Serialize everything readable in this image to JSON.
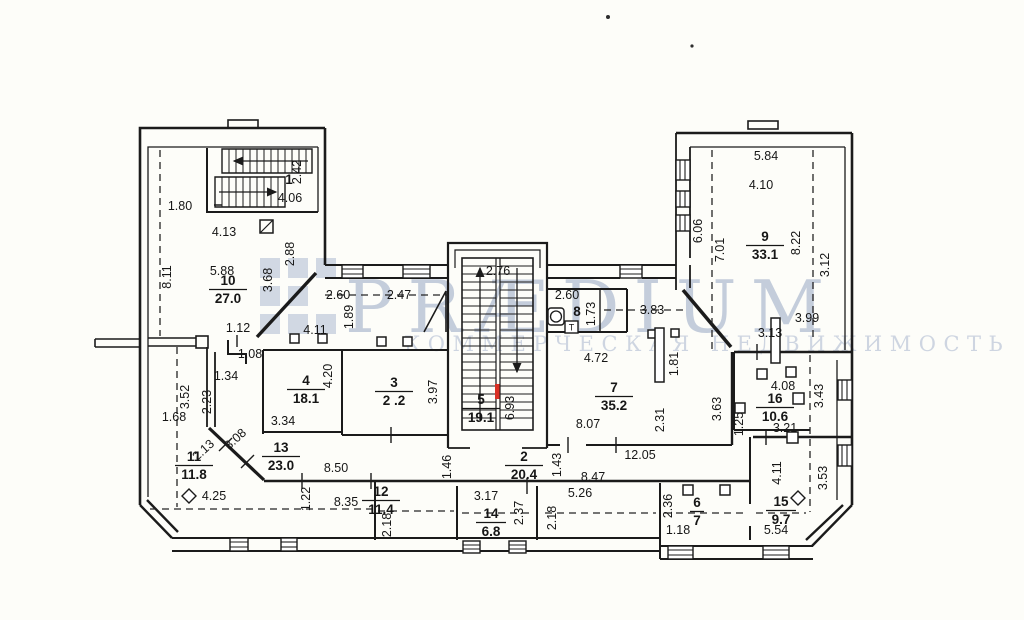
{
  "watermark": {
    "brand": "PRÆDIUM",
    "subtitle": "КОММЕРЧЕСКАЯ НЕДВИЖИМОСТЬ",
    "brand_color": "#b7c2d4",
    "subtitle_color": "#c6cfdd"
  },
  "colors": {
    "wall": "#1b1b1b",
    "red_mark": "#d93025",
    "paper": "#fdfdf9"
  },
  "symbols": {
    "towel_dryer_label": "Т"
  },
  "rooms": [
    {
      "number": "1",
      "area": "",
      "x": 289,
      "y": 184
    },
    {
      "number": "10",
      "area": "27.0",
      "x": 228,
      "y": 285
    },
    {
      "number": "4",
      "area": "18.1",
      "x": 306,
      "y": 385
    },
    {
      "number": "3",
      "area": "2 .2",
      "x": 394,
      "y": 387
    },
    {
      "number": "5",
      "area": "19.1",
      "x": 481,
      "y": 404
    },
    {
      "number": "2",
      "area": "20.4",
      "x": 524,
      "y": 461
    },
    {
      "number": "7",
      "area": "35.2",
      "x": 614,
      "y": 392
    },
    {
      "number": "8",
      "area": "",
      "x": 577,
      "y": 316
    },
    {
      "number": "9",
      "area": "33.1",
      "x": 765,
      "y": 241
    },
    {
      "number": "11",
      "area": "11.8",
      "x": 194,
      "y": 461
    },
    {
      "number": "12",
      "area": "11.4",
      "x": 381,
      "y": 496
    },
    {
      "number": "13",
      "area": "23.0",
      "x": 281,
      "y": 452
    },
    {
      "number": "14",
      "area": "6.8",
      "x": 491,
      "y": 518
    },
    {
      "number": "15",
      "area": "9.7",
      "x": 781,
      "y": 506
    },
    {
      "number": "16",
      "area": "10.6",
      "x": 775,
      "y": 403
    },
    {
      "number": "6",
      "area": "7",
      "x": 697,
      "y": 507
    }
  ],
  "dimensions": [
    {
      "t": "1.80",
      "x": 180,
      "y": 210,
      "r": 0
    },
    {
      "t": "8.11",
      "x": 171,
      "y": 277,
      "r": -90
    },
    {
      "t": "4.13",
      "x": 224,
      "y": 236,
      "r": 0
    },
    {
      "t": "5.88",
      "x": 222,
      "y": 275,
      "r": 0
    },
    {
      "t": "2.42",
      "x": 301,
      "y": 172,
      "r": -90
    },
    {
      "t": "4.06",
      "x": 290,
      "y": 202,
      "r": 0
    },
    {
      "t": "2.88",
      "x": 294,
      "y": 254,
      "r": -90
    },
    {
      "t": "3.68",
      "x": 272,
      "y": 280,
      "r": -90
    },
    {
      "t": "2.60",
      "x": 338,
      "y": 299,
      "r": 0
    },
    {
      "t": "2.47",
      "x": 399,
      "y": 299,
      "r": 0
    },
    {
      "t": "1.89",
      "x": 353,
      "y": 317,
      "r": -90
    },
    {
      "t": "4.11",
      "x": 315,
      "y": 334,
      "r": 0
    },
    {
      "t": "1.12",
      "x": 238,
      "y": 332,
      "r": 0
    },
    {
      "t": "1.08",
      "x": 250,
      "y": 358,
      "r": 0
    },
    {
      "t": "1.34",
      "x": 226,
      "y": 380,
      "r": 0
    },
    {
      "t": "3.52",
      "x": 189,
      "y": 397,
      "r": -90
    },
    {
      "t": "2.23",
      "x": 211,
      "y": 402,
      "r": -90
    },
    {
      "t": "1.68",
      "x": 174,
      "y": 421,
      "r": 0
    },
    {
      "t": "2.13",
      "x": 206,
      "y": 453,
      "r": -42
    },
    {
      "t": "3.08",
      "x": 238,
      "y": 442,
      "r": -42
    },
    {
      "t": "4.25",
      "x": 214,
      "y": 500,
      "r": 0
    },
    {
      "t": "3.34",
      "x": 283,
      "y": 425,
      "r": 0
    },
    {
      "t": "4.20",
      "x": 332,
      "y": 376,
      "r": -90
    },
    {
      "t": "3.97",
      "x": 437,
      "y": 392,
      "r": -90
    },
    {
      "t": "2.76",
      "x": 498,
      "y": 275,
      "r": 0
    },
    {
      "t": "6.93",
      "x": 514,
      "y": 408,
      "r": -90
    },
    {
      "t": "2.60",
      "x": 567,
      "y": 299,
      "r": 0
    },
    {
      "t": "1.73",
      "x": 595,
      "y": 314,
      "r": -90
    },
    {
      "t": "3.83",
      "x": 652,
      "y": 314,
      "r": 0
    },
    {
      "t": "4.72",
      "x": 596,
      "y": 362,
      "r": 0
    },
    {
      "t": "1.81",
      "x": 678,
      "y": 364,
      "r": -90
    },
    {
      "t": "5.84",
      "x": 766,
      "y": 160,
      "r": 0
    },
    {
      "t": "4.10",
      "x": 761,
      "y": 189,
      "r": 0
    },
    {
      "t": "6.06",
      "x": 702,
      "y": 231,
      "r": -90
    },
    {
      "t": "7.01",
      "x": 724,
      "y": 250,
      "r": -90
    },
    {
      "t": "8.22",
      "x": 800,
      "y": 243,
      "r": -90
    },
    {
      "t": "3.12",
      "x": 829,
      "y": 265,
      "r": -90
    },
    {
      "t": "3.99",
      "x": 807,
      "y": 322,
      "r": 0
    },
    {
      "t": "3.13",
      "x": 770,
      "y": 337,
      "r": 0
    },
    {
      "t": "8.07",
      "x": 588,
      "y": 428,
      "r": 0
    },
    {
      "t": "2.31",
      "x": 664,
      "y": 420,
      "r": -90
    },
    {
      "t": "3.63",
      "x": 721,
      "y": 409,
      "r": -90
    },
    {
      "t": "1.25",
      "x": 743,
      "y": 424,
      "r": -90
    },
    {
      "t": "12.05",
      "x": 640,
      "y": 459,
      "r": 0
    },
    {
      "t": "8.50",
      "x": 336,
      "y": 472,
      "r": 0
    },
    {
      "t": "1.22",
      "x": 310,
      "y": 499,
      "r": -90
    },
    {
      "t": "8.35",
      "x": 346,
      "y": 506,
      "r": 0
    },
    {
      "t": "1.46",
      "x": 451,
      "y": 467,
      "r": -90
    },
    {
      "t": "1.43",
      "x": 561,
      "y": 465,
      "r": -90
    },
    {
      "t": "8.47",
      "x": 593,
      "y": 481,
      "r": 0
    },
    {
      "t": "2.18",
      "x": 391,
      "y": 525,
      "r": -90
    },
    {
      "t": "3.17",
      "x": 486,
      "y": 500,
      "r": 0
    },
    {
      "t": "2.37",
      "x": 523,
      "y": 513,
      "r": -90
    },
    {
      "t": "5.26",
      "x": 580,
      "y": 497,
      "r": 0
    },
    {
      "t": "2.18",
      "x": 556,
      "y": 518,
      "r": -90
    },
    {
      "t": "2.36",
      "x": 672,
      "y": 506,
      "r": -90
    },
    {
      "t": "1.18",
      "x": 678,
      "y": 534,
      "r": 0
    },
    {
      "t": "4.08",
      "x": 783,
      "y": 390,
      "r": 0
    },
    {
      "t": "3.43",
      "x": 823,
      "y": 396,
      "r": -90
    },
    {
      "t": "3.21",
      "x": 785,
      "y": 432,
      "r": 0
    },
    {
      "t": "4.11",
      "x": 781,
      "y": 473,
      "r": -90
    },
    {
      "t": "5.54",
      "x": 776,
      "y": 534,
      "r": 0
    },
    {
      "t": "3.53",
      "x": 827,
      "y": 478,
      "r": -90
    }
  ]
}
